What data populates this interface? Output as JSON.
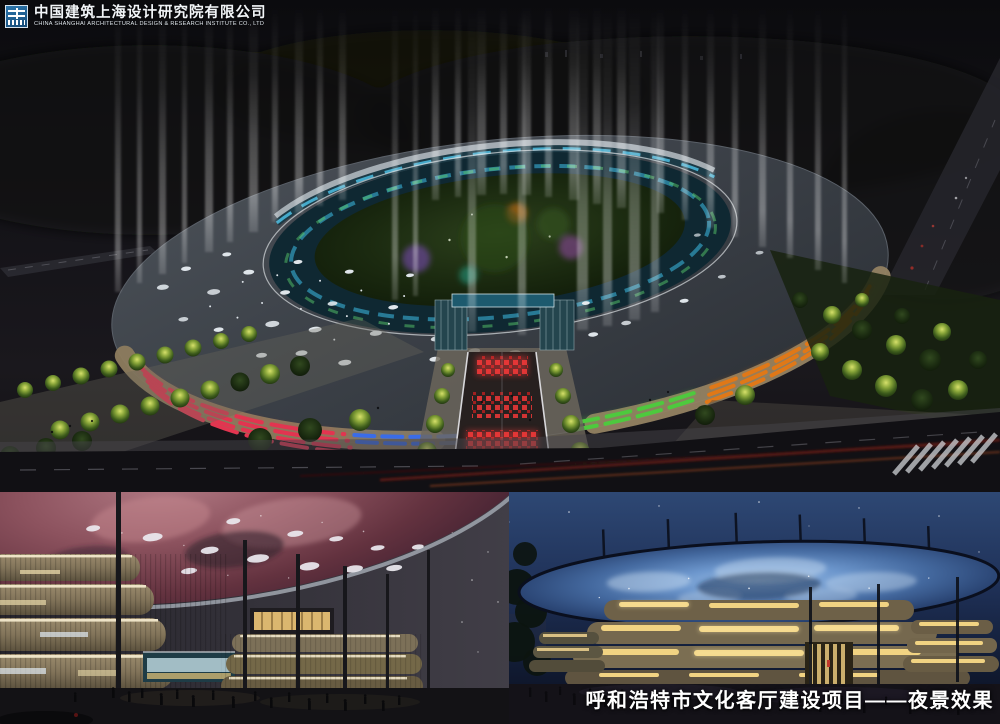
{
  "logo": {
    "icon": "cscec-logo-icon",
    "company_cn": "中国建筑上海设计研究院有限公司",
    "company_en": "CHINA SHANGHAI ARCHITECTURAL DESIGN & RESEARCH INSTITUTE CO., LTD"
  },
  "caption": {
    "text": "呼和浩特市文化客厅建设项目——夜景效果"
  },
  "colors": {
    "logo_blue": "#1d5c8e",
    "sky_dark": "#121116",
    "roof_slate": "#3b4046",
    "facade_tan": "#9e8d6e",
    "facade_red": "#e23550",
    "facade_magenta": "#d348cc",
    "facade_purple": "#6a3fe0",
    "facade_blue": "#3a6ce8",
    "facade_cyan": "#3fc8e8",
    "facade_green": "#4ec93e",
    "facade_orange": "#e07818",
    "facade_yellow": "#e0c030",
    "courtyard_green": "#1b2a10",
    "red_carpet": "#d23434",
    "galaxy_canopy_pink": "#8c525e",
    "starry_canopy_blue": "#44699f",
    "warm_light": "#f1d382",
    "night_sky_blue": "#1f3158",
    "caption_white": "#ffffff"
  }
}
